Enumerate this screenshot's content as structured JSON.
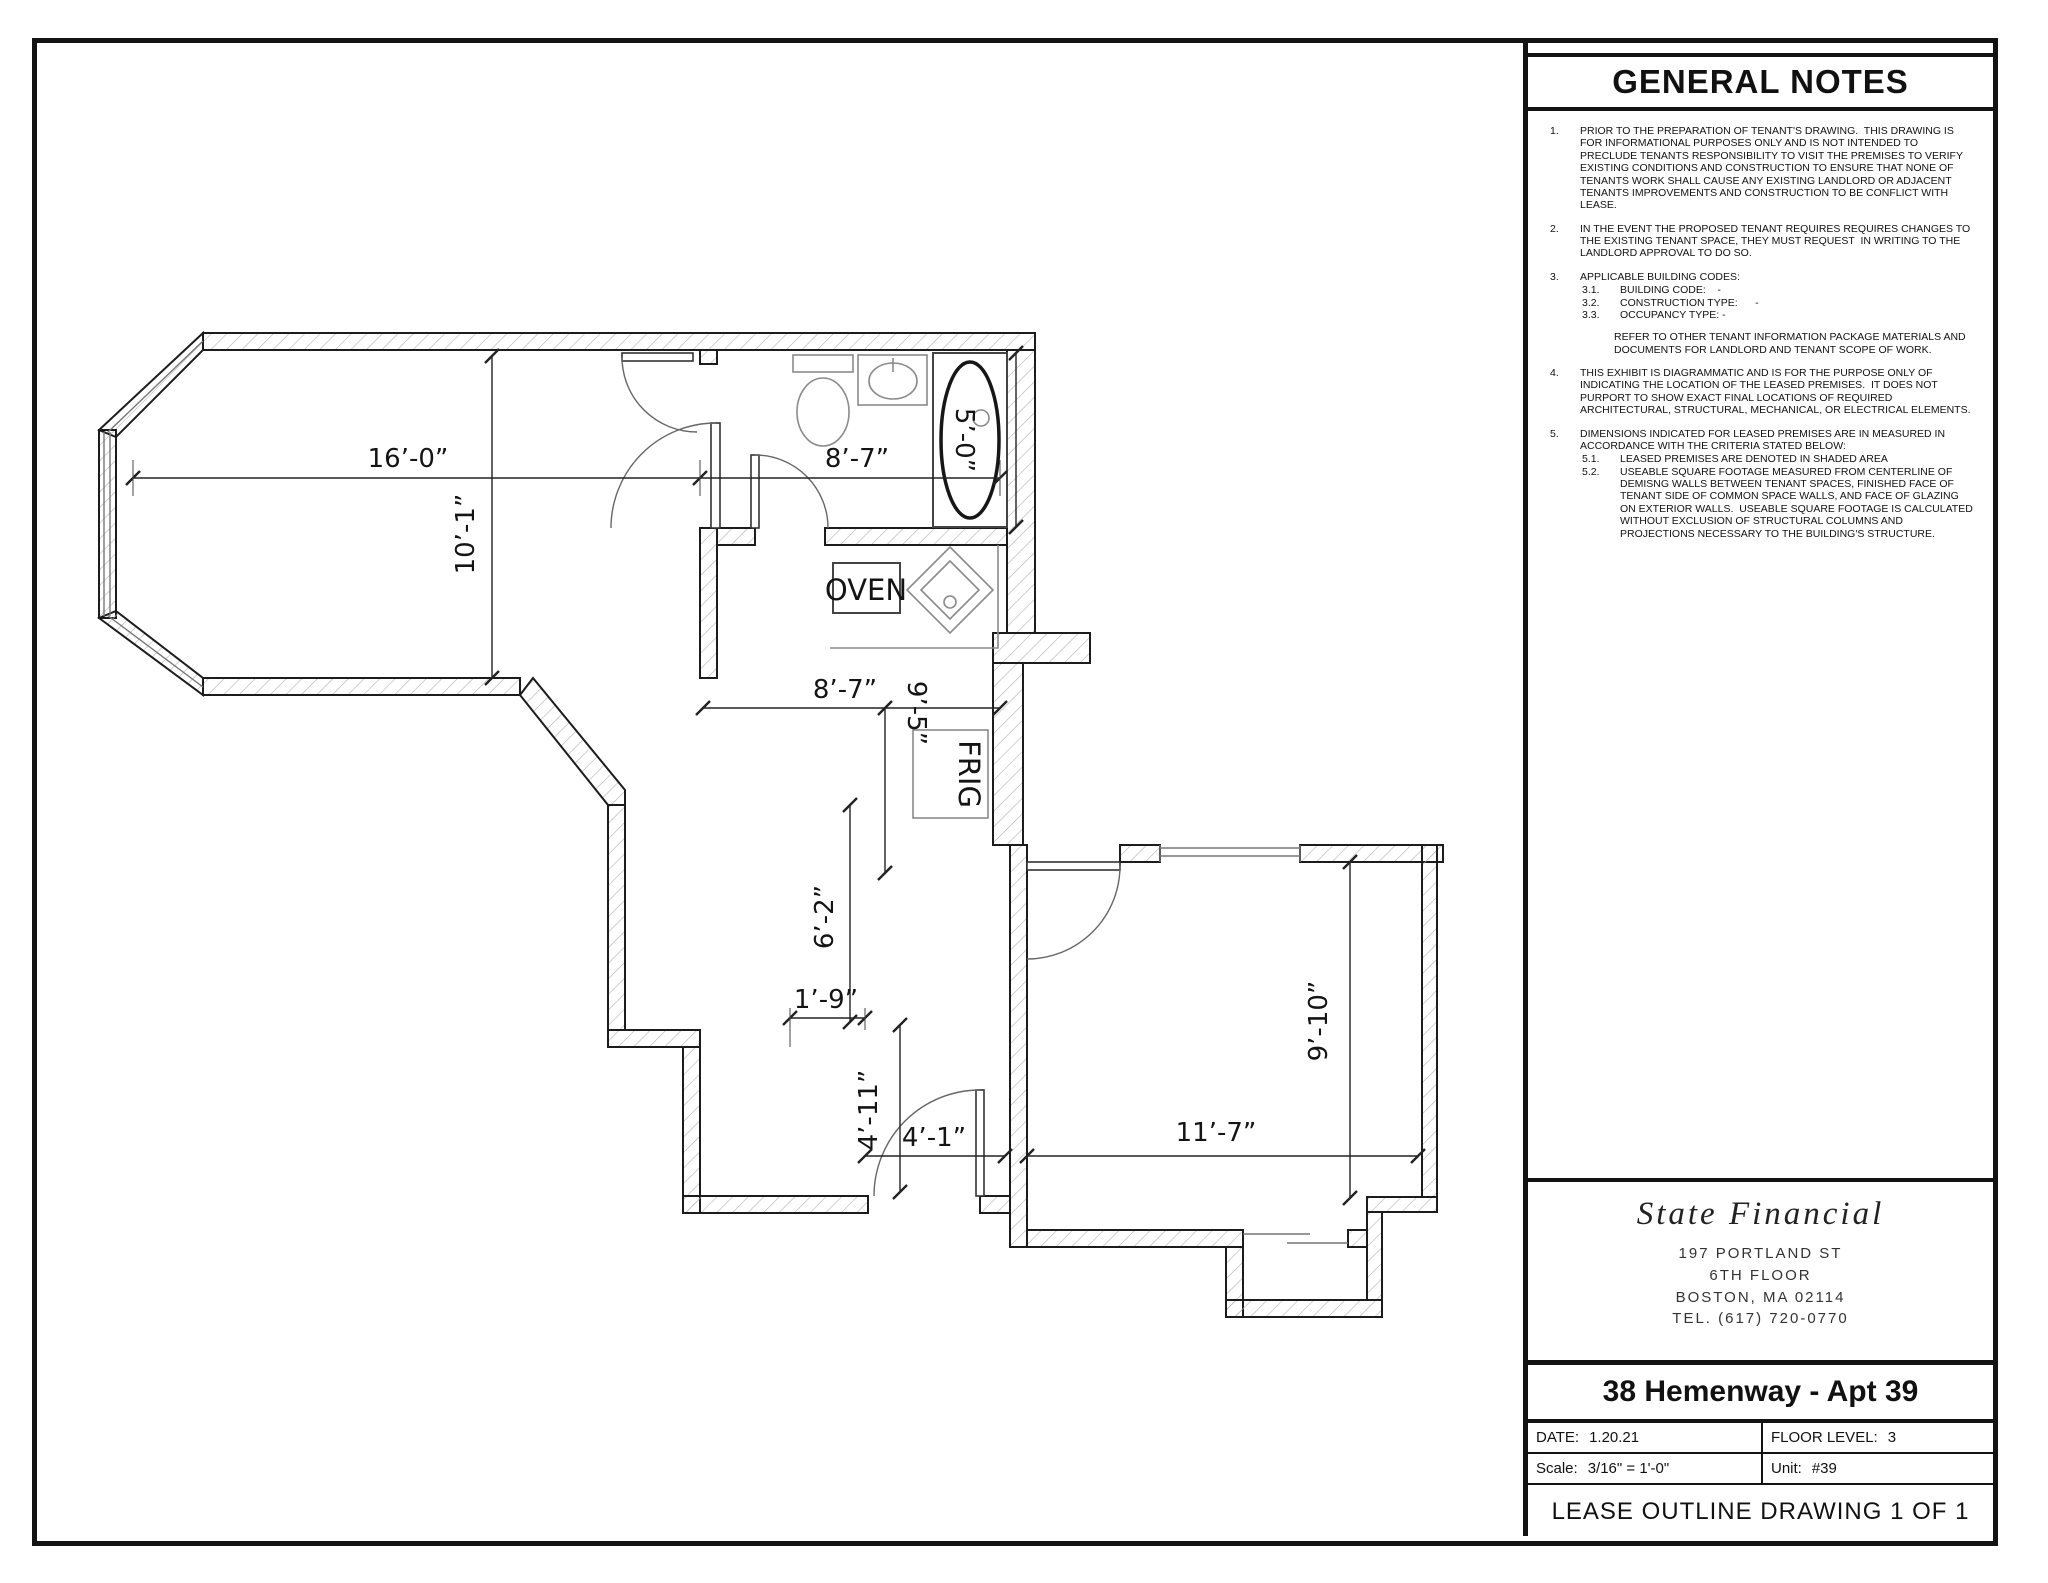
{
  "general_notes": {
    "title": "GENERAL NOTES",
    "items": [
      {
        "num": "1.",
        "text": "PRIOR TO THE PREPARATION OF TENANT'S DRAWING.  THIS DRAWING IS FOR INFORMATIONAL PURPOSES ONLY AND IS NOT INTENDED TO PRECLUDE TENANTS RESPONSIBILITY TO VISIT THE PREMISES TO VERIFY EXISTING CONDITIONS AND CONSTRUCTION TO ENSURE THAT NONE OF TENANTS WORK SHALL CAUSE ANY EXISTING LANDLORD OR ADJACENT TENANTS IMPROVEMENTS AND CONSTRUCTION TO BE CONFLICT WITH LEASE."
      },
      {
        "num": "2.",
        "text": "IN THE EVENT THE PROPOSED TENANT REQUIRES REQUIRES CHANGES TO THE EXISTING TENANT SPACE, THEY MUST REQUEST  IN WRITING TO THE LANDLORD APPROVAL TO DO SO."
      },
      {
        "num": "3.",
        "text": "APPLICABLE BUILDING CODES:",
        "subs": [
          {
            "num": "3.1.",
            "text": "BUILDING CODE:    -"
          },
          {
            "num": "3.2.",
            "text": "CONSTRUCTION TYPE:      -"
          },
          {
            "num": "3.3.",
            "text": "OCCUPANCY TYPE: -"
          }
        ],
        "extra": "REFER TO OTHER TENANT INFORMATION PACKAGE MATERIALS AND DOCUMENTS FOR LANDLORD AND TENANT SCOPE OF WORK."
      },
      {
        "num": "4.",
        "text": "THIS EXHIBIT IS DIAGRAMMATIC AND IS FOR THE PURPOSE ONLY OF INDICATING THE LOCATION OF THE LEASED PREMISES.  IT DOES NOT PURPORT TO SHOW EXACT FINAL LOCATIONS OF REQUIRED ARCHITECTURAL, STRUCTURAL, MECHANICAL, OR ELECTRICAL ELEMENTS."
      },
      {
        "num": "5.",
        "text": "DIMENSIONS INDICATED FOR LEASED PREMISES ARE IN MEASURED IN ACCORDANCE WITH THE CRITERIA STATED BELOW:",
        "subs": [
          {
            "num": "5.1.",
            "text": "LEASED PREMISES ARE DENOTED IN SHADED AREA"
          },
          {
            "num": "5.2.",
            "text": "USEABLE SQUARE FOOTAGE MEASURED FROM CENTERLINE OF DEMISNG WALLS BETWEEN TENANT SPACES, FINISHED FACE OF TENANT SIDE OF COMMON SPACE WALLS, AND FACE OF GLAZING ON EXTERIOR WALLS.  USEABLE SQUARE FOOTAGE IS CALCULATED WITHOUT EXCLUSION OF STRUCTURAL COLUMNS AND PROJECTIONS NECESSARY TO THE BUILDING'S STRUCTURE."
          }
        ]
      }
    ]
  },
  "title_block": {
    "company": "State Financial",
    "address_line1": "197 PORTLAND ST",
    "address_line2": "6TH FLOOR",
    "address_line3": "BOSTON, MA 02114",
    "address_line4": "TEL. (617) 720-0770",
    "project": "38 Hemenway - Apt 39",
    "date_label": "DATE:",
    "date": "1.20.21",
    "floor_label": "FLOOR LEVEL:",
    "floor": "3",
    "scale_label": "Scale:",
    "scale": "3/16\" = 1'-0\"",
    "unit_label": "Unit:",
    "unit": "#39",
    "footer": "LEASE OUTLINE DRAWING 1 OF 1"
  },
  "plan": {
    "appliances": {
      "oven": "OVEN",
      "frig": "FRIG"
    },
    "dims": {
      "living_width": "16’-0”",
      "living_depth": "10’-1”",
      "bath_width": "8’-7”",
      "tub_length": "5’-0”",
      "kitchen_width": "8’-7”",
      "kitchen_depth": "9’-5”",
      "hall_length": "6’-2”",
      "hall_jog": "1’-9”",
      "entry_depth": "4’-11”",
      "entry_width": "4’-1”",
      "bedroom_width": "11’-7”",
      "bedroom_depth": "9’-10”"
    }
  }
}
